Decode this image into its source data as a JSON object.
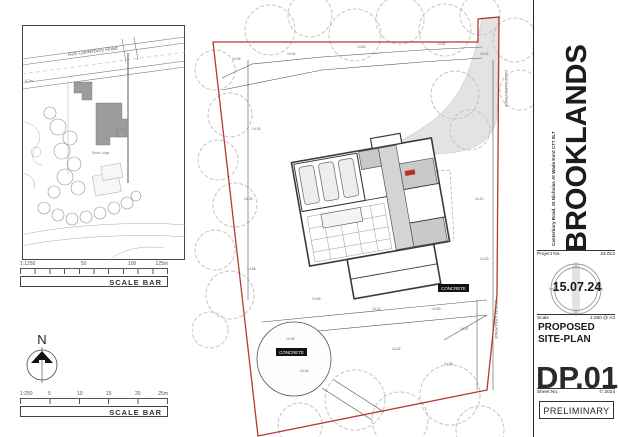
{
  "location_plan": {
    "road_label": "A28 Canterbury Road",
    "spot_height": "8.7m",
    "building_label": "Dene Lodge"
  },
  "scale_bar_top": {
    "ratio": "1:1250",
    "tick_mid": "50",
    "tick_mid2": "100",
    "end": "125m",
    "label": "SCALE BAR"
  },
  "north": {
    "label": "N"
  },
  "scale_bar_bottom": {
    "ratio": "1:250",
    "ticks": [
      "5",
      "10",
      "15",
      "20"
    ],
    "end": "25m",
    "label": "SCALE BAR"
  },
  "site_plan": {
    "concrete_label_upper": "CONCRETE",
    "concrete_label_lower": "CONCRETE",
    "fence_label_right": "MT POST & RAIL FENCE",
    "fence_label_upper": "CLOSE BOARD FENCE",
    "spot_levels": [
      "14.05",
      "14.54",
      "14.63",
      "14.52",
      "14.21",
      "14.30",
      "14.39",
      "14.68",
      "14.65",
      "14.24",
      "14.80",
      "14.47",
      "14.35",
      "14.60",
      "14.42",
      "14.58",
      "14.12",
      "14.33"
    ]
  },
  "title_block": {
    "address": "Canterbury Road, St Nicholas At Wade Kent CT7 0LT",
    "project_name": "BROOKLANDS",
    "project_no_label": "Project No.",
    "project_no": "24.012",
    "date": "15.07.24",
    "scale_label": "Scale",
    "scale_value": "1:250 @ A3",
    "drawing_title_line1": "PROPOSED",
    "drawing_title_line2": "SITE-PLAN",
    "drawing_number": "DP.01",
    "sheet_label": "Sheet No.",
    "sheet_value": "© 2024",
    "status": "PRELIMINARY"
  },
  "colors": {
    "boundary_red": "#b23b32",
    "tree_gray": "#c4c4c4",
    "building_gray": "#9c9c9c",
    "surface_gray": "#e3e3e3"
  }
}
